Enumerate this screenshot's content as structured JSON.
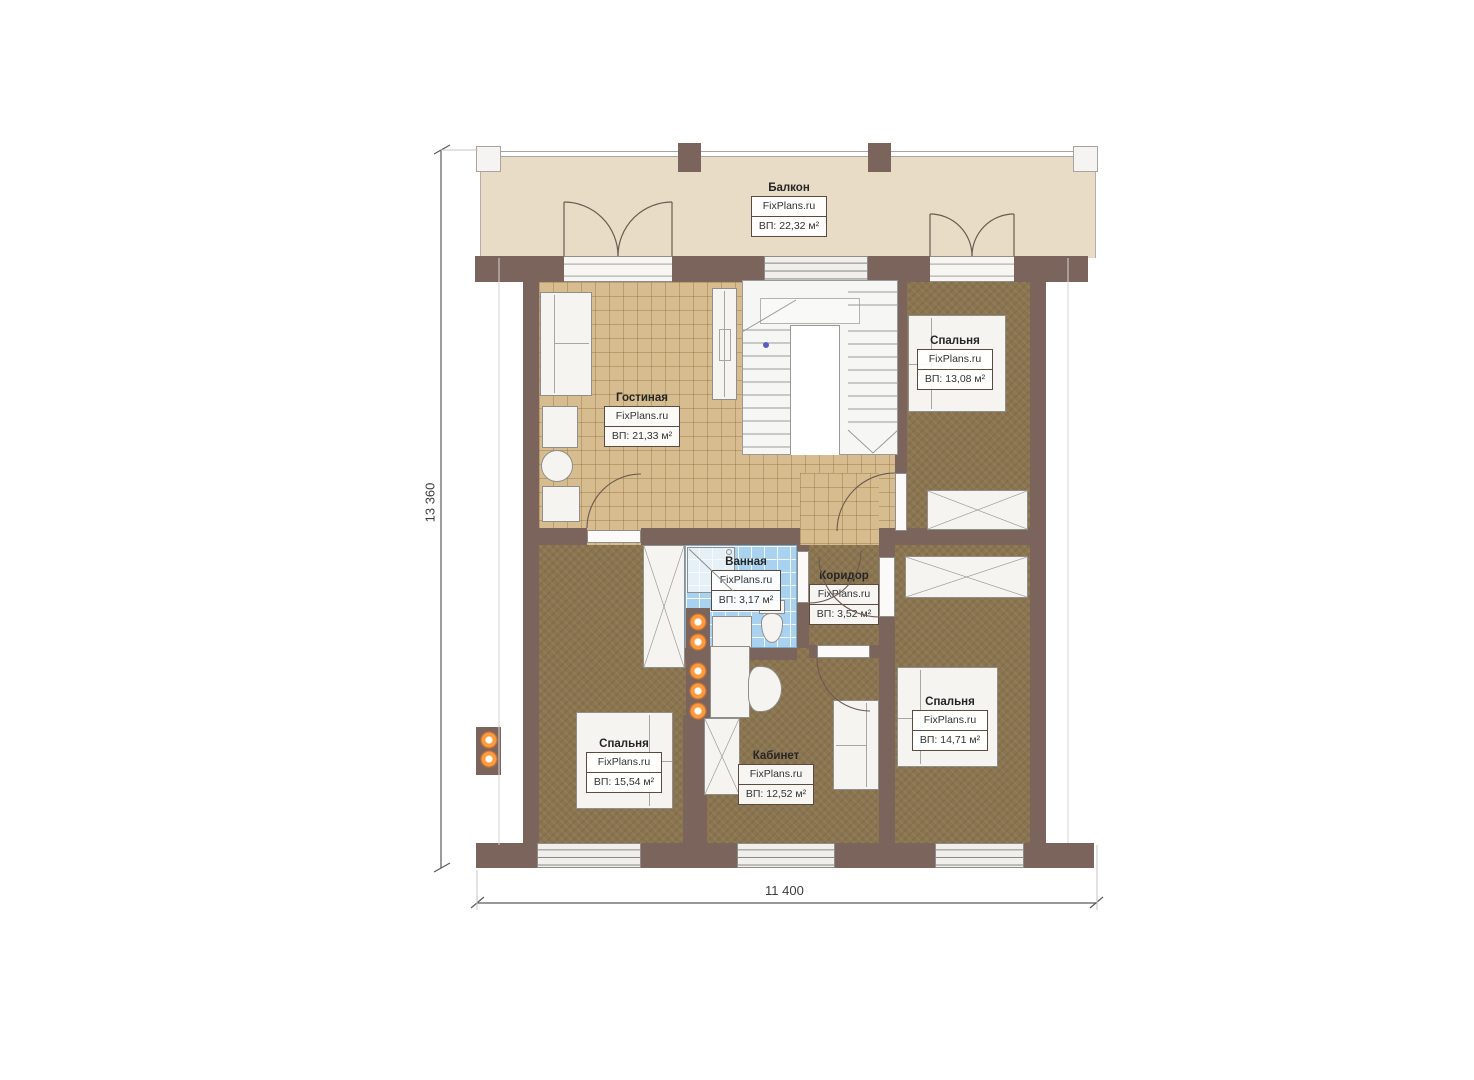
{
  "brand": "FixPlans.ru",
  "rooms": {
    "balcony": {
      "name": "Балкон",
      "area": "ВП: 22,32 м²"
    },
    "living": {
      "name": "Гостиная",
      "area": "ВП: 21,33 м²"
    },
    "bedroom_top": {
      "name": "Спальня",
      "area": "ВП: 13,08 м²"
    },
    "bathroom": {
      "name": "Ванная",
      "area": "ВП: 3,17 м²"
    },
    "corridor": {
      "name": "Коридор",
      "area": "ВП: 3,52 м²"
    },
    "bedroom_left": {
      "name": "Спальня",
      "area": "ВП: 15,54 м²"
    },
    "study": {
      "name": "Кабинет",
      "area": "ВП: 12,52 м²"
    },
    "bedroom_right": {
      "name": "Спальня",
      "area": "ВП: 14,71 м²"
    }
  },
  "dimensions": {
    "height": "13 360",
    "width": "11 400"
  },
  "colors": {
    "wall": "#7b645c",
    "tile_floor": "#d6bc8e",
    "carpet_floor": "#8b7550",
    "bathroom_tile": "#a9d2f1",
    "balcony_floor": "#e9dcc7",
    "light_accent": "#ff9a3c"
  }
}
